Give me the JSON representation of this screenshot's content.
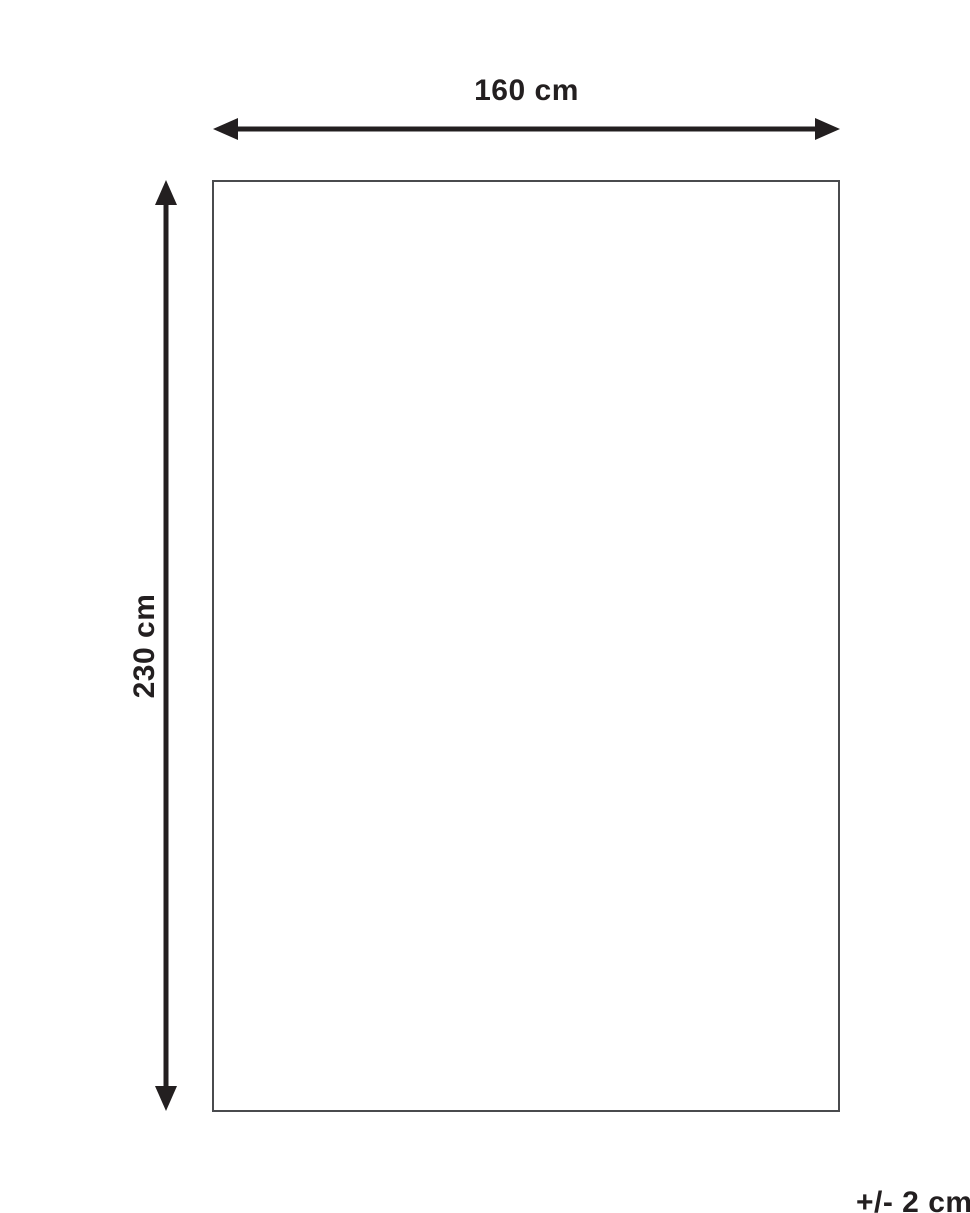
{
  "diagram": {
    "title": "product-dimension-diagram",
    "width_label": "160 cm",
    "height_label": "230 cm",
    "tolerance_label": "+/- 2 cm",
    "colors": {
      "ink": "#231f20",
      "outline": "#4a4b4e",
      "background": "#ffffff"
    }
  }
}
